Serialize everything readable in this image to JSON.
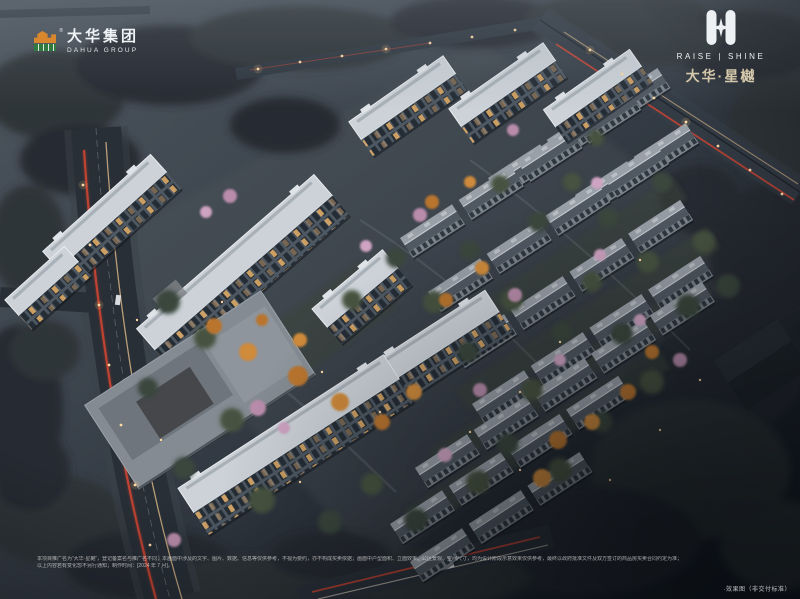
{
  "branding": {
    "dahua": {
      "name_cn": "大华集团",
      "name_en": "DAHUA GROUP",
      "registered_mark": "®"
    },
    "project": {
      "tagline": "RAISE | SHINE",
      "name": "大华·星樾"
    }
  },
  "footer": {
    "disclaimer_line1": "本项目推广名为“大华·星樾”，登记备案名与推广名不同；本画面中涉及的文字、图片、数据、信息等仅供参考，不视为要约，亦不构成买卖依据；画面中户型面积、立面效果、公区景观、空间尺寸，均为设计阶段示意效果仅供参考，最终以政府批准文件及双方签订的商品房买卖合同约定为准；",
    "disclaimer_line2": "以上内容若有变化恕不另行通知；制作时间：[2024 年 7 月]。",
    "watermark": "·效果图（非交付标准）"
  },
  "colors": {
    "accent_gold": "#d6c9ab",
    "tail_light_red": "#c5402e",
    "warm_window": "#e9b26a",
    "dusk_sky": "#4d555e",
    "night_shadow": "#141a21",
    "logo_orange": "#d8872f",
    "logo_green": "#2f7a3f"
  },
  "icons": {
    "dahua_logo_icon": "stylized-building-mark",
    "project_emblem_icon": "four-point-star-twin-shield"
  }
}
